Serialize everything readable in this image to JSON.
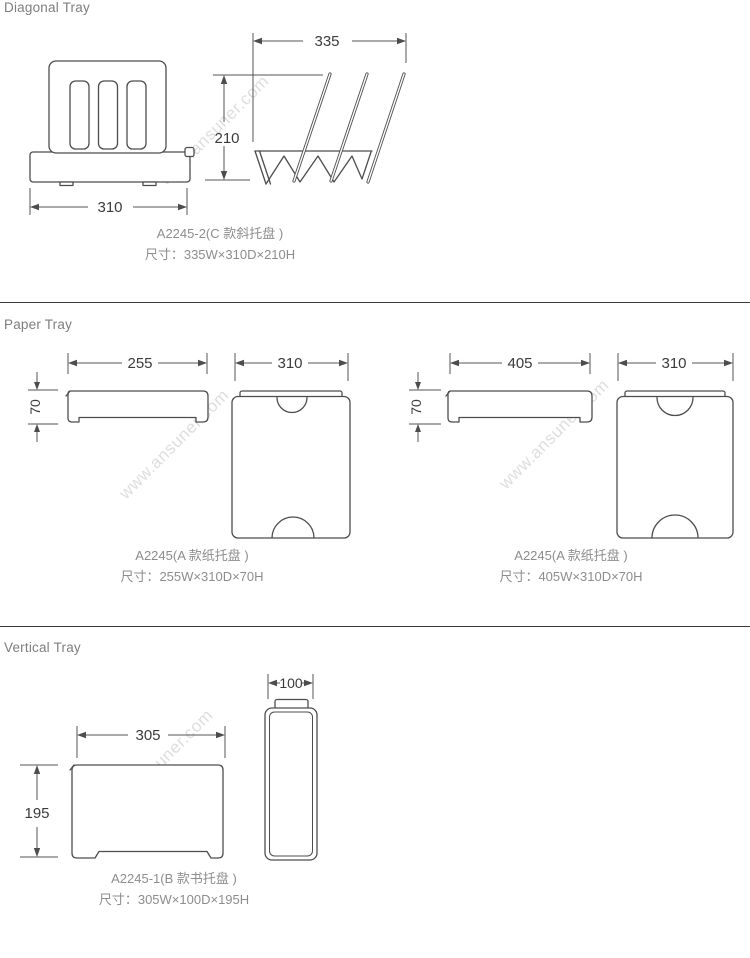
{
  "watermark": "www.ansuner.com",
  "diagonal": {
    "heading": "Diagonal Tray",
    "front_width": "310",
    "side_width": "335",
    "height": "210",
    "model": "A2245-2(C 款斜托盘 )",
    "size": "尺寸：335W×310D×210H"
  },
  "paper": {
    "heading": "Paper Tray",
    "left": {
      "width": "255",
      "height": "70",
      "depth": "310",
      "model": "A2245(A 款纸托盘 )",
      "size": "尺寸：255W×310D×70H"
    },
    "right": {
      "width": "405",
      "height": "70",
      "depth": "310",
      "model": "A2245(A 款纸托盘 )",
      "size": "尺寸：405W×310D×70H"
    }
  },
  "vertical": {
    "heading": "Vertical Tray",
    "width": "305",
    "height": "195",
    "depth": "100",
    "model": "A2245-1(B 款书托盘 )",
    "size": "尺寸：305W×100D×195H"
  }
}
